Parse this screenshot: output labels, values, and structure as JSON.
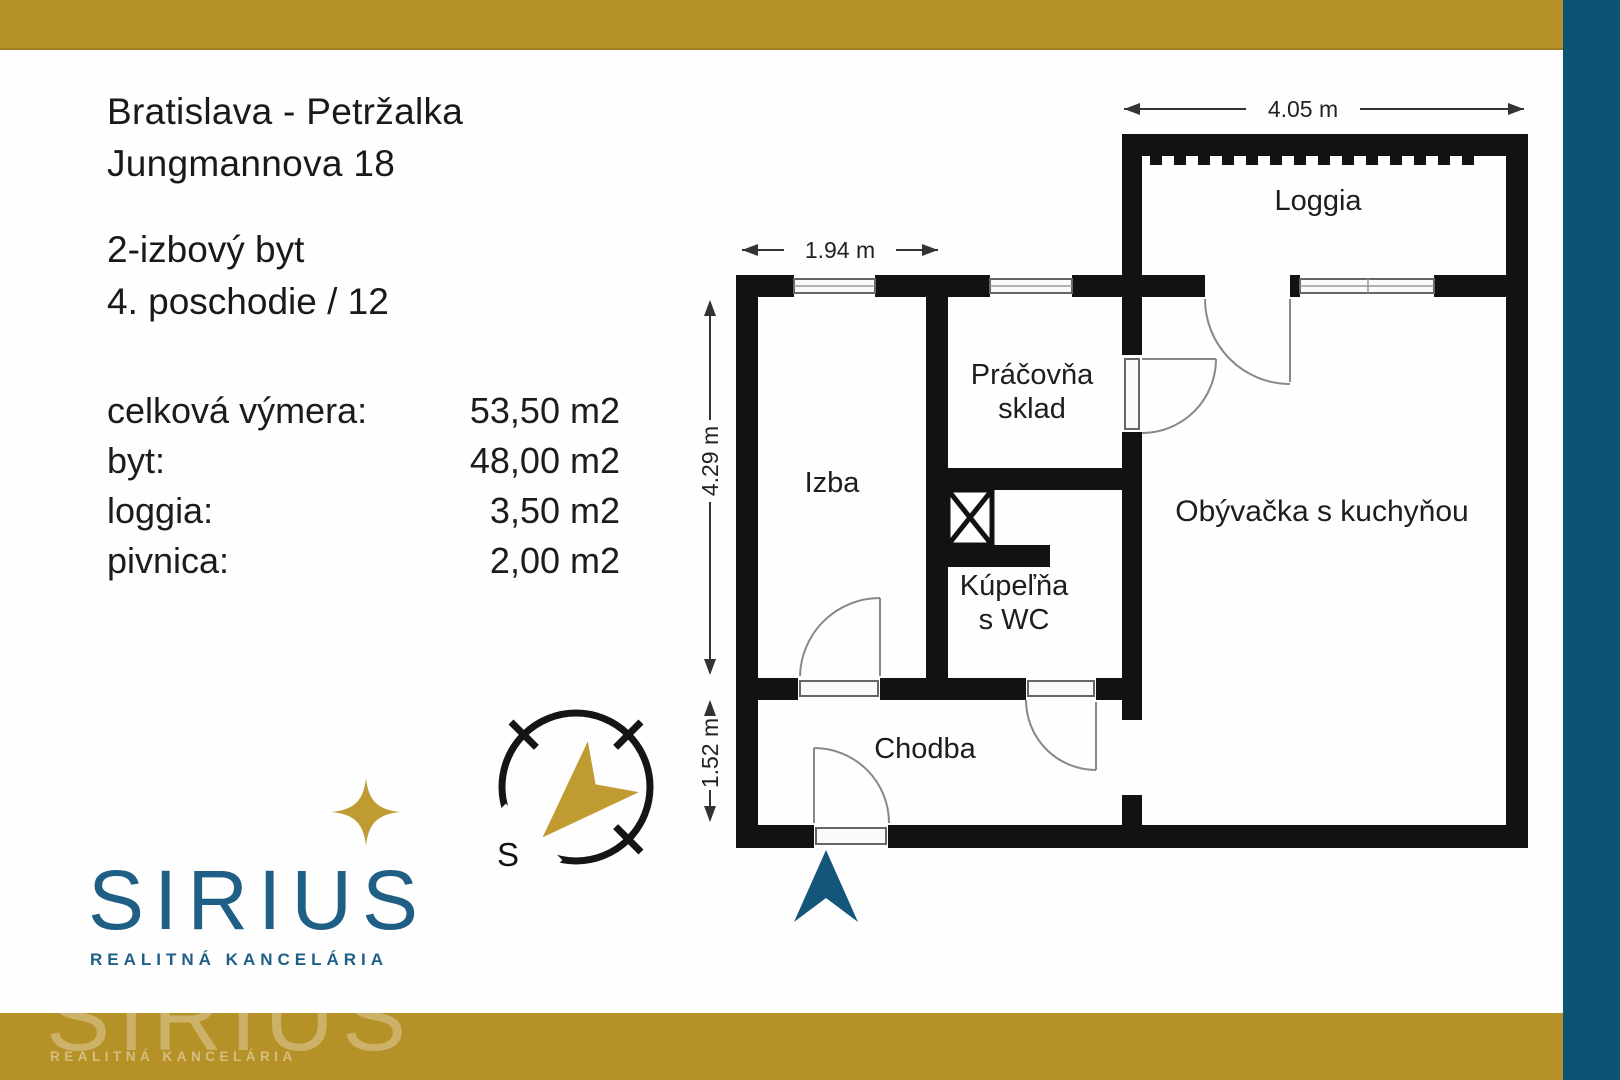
{
  "colors": {
    "gold": "#b69127",
    "gold-bright": "#bf9b31",
    "teal-bar": "#0d5474",
    "logo-teal": "#1f5f85",
    "arrow-teal": "#14567a",
    "wall": "#121212"
  },
  "header": {
    "location": "Bratislava - Petržalka",
    "street": "Jungmannova 18",
    "apartment_type": "2-izbový byt",
    "floor": "4. poschodie / 12"
  },
  "areas": {
    "rows": [
      {
        "label": "celková výmera:",
        "value": "53,50 m2"
      },
      {
        "label": "byt:",
        "value": "48,00 m2"
      },
      {
        "label": "loggia:",
        "value": "3,50 m2"
      },
      {
        "label": "pivnica:",
        "value": "2,00 m2"
      }
    ]
  },
  "logo": {
    "name": "SIRIUS",
    "tagline": "REALITNÁ KANCELÁRIA"
  },
  "watermark": {
    "name": "SIRIUS",
    "tagline": "REALITNÁ KANCELÁRIA"
  },
  "compass": {
    "south": "S"
  },
  "floorplan": {
    "rooms": {
      "loggia": "Loggia",
      "izba": "Izba",
      "pracovna_line1": "Práčovňa",
      "pracovna_line2": "sklad",
      "obyvacka": "Obývačka s kuchyňou",
      "kupelna_line1": "Kúpeľňa",
      "kupelna_line2": "s WC",
      "chodba": "Chodba"
    },
    "dims": {
      "loggia_width": "4.05 m",
      "izba_width": "1.94 m",
      "izba_height": "4.29 m",
      "chodba_height": "1.52 m"
    }
  }
}
